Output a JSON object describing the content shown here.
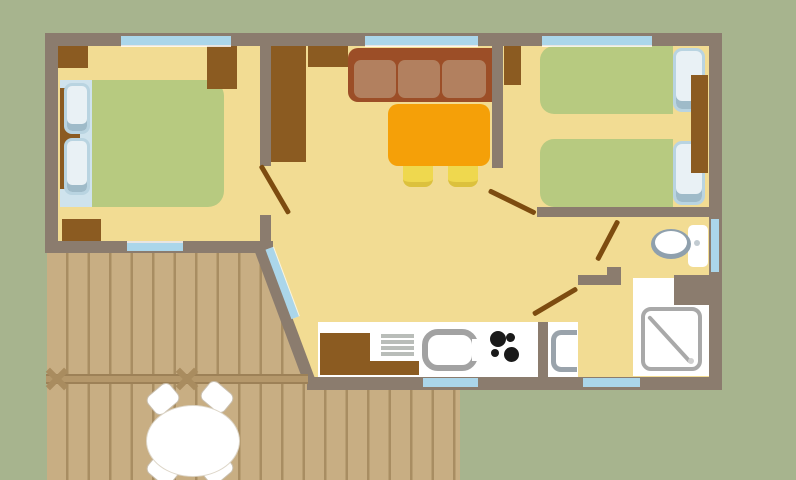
{
  "scene": "mobile-home-floor-plan",
  "canvas": {
    "width": 796,
    "height": 480,
    "background": "#a7b48e"
  },
  "palette": {
    "background_green": "#a7b48e",
    "wall_gray": "#8b7c6e",
    "floor_yellow": "#f2dc93",
    "furniture_brown": "#8b5b21",
    "sofa_dark": "#9c4e27",
    "sofa_light": "#b2805f",
    "table_orange": "#f5a008",
    "stool_yellow": "#efd84e",
    "mattress_green": "#b7ca80",
    "window_blue": "#abd6ea",
    "pillow_blue": "#cfe3ed",
    "deck_plank": "#c8ae83",
    "deck_line": "#a88d62",
    "door_line_brown": "#7d4c10",
    "fixture_white": "#ffffff",
    "fixture_gray": "#a2a2a2"
  },
  "elements": [
    {
      "n": "interior-floor",
      "x": 58,
      "y": 46,
      "w": 651,
      "h": 331,
      "bg": "#f2dc93"
    },
    {
      "n": "deck-planks",
      "x": 47,
      "y": 252,
      "w": 413,
      "h": 228,
      "bg": "repeating-linear-gradient(90deg,#c8ae83 0px,#c8ae83 19px,#a88d62 19px,#a88d62 21.5px)",
      "clip": "polygon(0px 0px, 218px 0px, 266px 125px, 266px 138px, 413px 138px, 413px 228px, 0px 228px)"
    },
    {
      "n": "kitchen-counter",
      "x": 318,
      "y": 322,
      "w": 220,
      "h": 55,
      "bg": "#ffffff"
    },
    {
      "n": "washbasin-area-floor",
      "x": 548,
      "y": 322,
      "w": 30,
      "h": 55,
      "bg": "#ffffff"
    },
    {
      "n": "shower-room-floor",
      "x": 633,
      "y": 278,
      "w": 76,
      "h": 98,
      "bg": "#ffffff"
    },
    {
      "n": "bed1-headboard-base",
      "x": 60,
      "y": 80,
      "w": 33,
      "h": 127,
      "bg": "#cfe3ed"
    },
    {
      "n": "bed1-headboard-wood",
      "x": 60,
      "y": 88,
      "w": 20,
      "h": 101,
      "bg": "#8b5b21"
    },
    {
      "n": "bed1-pillow-top",
      "x": 64,
      "y": 83,
      "w": 26,
      "h": 51,
      "bg": "#e9f1f5",
      "border": "3px solid #b9d4e1",
      "r": "8px",
      "shadow": "inset 0 -7px 0 #9fbbc9"
    },
    {
      "n": "bed1-pillow-bottom",
      "x": 64,
      "y": 138,
      "w": 26,
      "h": 57,
      "bg": "#e9f1f5",
      "border": "3px solid #b9d4e1",
      "r": "8px",
      "shadow": "inset 0 -7px 0 #9fbbc9"
    },
    {
      "n": "bed1-mattress",
      "x": 92,
      "y": 80,
      "w": 132,
      "h": 127,
      "bg": "#b7ca80",
      "r": "0 16px 16px 0"
    },
    {
      "n": "bedroom1-corner-cabinet",
      "x": 58,
      "y": 46,
      "w": 30,
      "h": 22,
      "bg": "#8b5b21"
    },
    {
      "n": "bedroom1-wardrobe",
      "x": 207,
      "y": 46,
      "w": 30,
      "h": 43,
      "bg": "#8b5b21"
    },
    {
      "n": "bedroom1-low-cabinet",
      "x": 62,
      "y": 219,
      "w": 39,
      "h": 22,
      "bg": "#8b5b21"
    },
    {
      "n": "living-closet",
      "x": 271,
      "y": 46,
      "w": 35,
      "h": 116,
      "bg": "#8b5b21"
    },
    {
      "n": "living-shelf",
      "x": 308,
      "y": 46,
      "w": 40,
      "h": 21,
      "bg": "#8b5b21"
    },
    {
      "n": "sofa-frame",
      "x": 348,
      "y": 48,
      "w": 145,
      "h": 54,
      "bg": "#9c4e27",
      "r": "10px 0 0 10px"
    },
    {
      "n": "sofa-cushion-1",
      "x": 354,
      "y": 60,
      "w": 42,
      "h": 38,
      "bg": "#b2805f",
      "r": "7px"
    },
    {
      "n": "sofa-cushion-2",
      "x": 398,
      "y": 60,
      "w": 42,
      "h": 38,
      "bg": "#b2805f",
      "r": "7px"
    },
    {
      "n": "sofa-cushion-3",
      "x": 442,
      "y": 60,
      "w": 44,
      "h": 38,
      "bg": "#b2805f",
      "r": "7px"
    },
    {
      "n": "dining-table",
      "x": 388,
      "y": 104,
      "w": 102,
      "h": 62,
      "bg": "#f5a008",
      "r": "10px"
    },
    {
      "n": "stool-1",
      "x": 403,
      "y": 166,
      "w": 30,
      "h": 21,
      "bg": "#efd84e",
      "r": "0 0 8px 8px",
      "css": {
        "borderBottom": "5px solid #dcc13d"
      }
    },
    {
      "n": "stool-2",
      "x": 448,
      "y": 166,
      "w": 30,
      "h": 21,
      "bg": "#efd84e",
      "r": "0 0 8px 8px",
      "css": {
        "borderBottom": "5px solid #dcc13d"
      }
    },
    {
      "n": "bedroom2-closet",
      "x": 504,
      "y": 46,
      "w": 17,
      "h": 39,
      "bg": "#8b5b21"
    },
    {
      "n": "bed2a-mattress",
      "x": 540,
      "y": 46,
      "w": 133,
      "h": 68,
      "bg": "#b7ca80",
      "r": "14px 0 0 14px"
    },
    {
      "n": "bed2a-pillow",
      "x": 673,
      "y": 48,
      "w": 32,
      "h": 64,
      "bg": "#e9f1f5",
      "border": "3px solid #b9d4e1",
      "r": "9px",
      "shadow": "inset 0 -8px 0 #9fbbc9"
    },
    {
      "n": "bed2b-mattress",
      "x": 540,
      "y": 139,
      "w": 133,
      "h": 68,
      "bg": "#b7ca80",
      "r": "14px 0 0 14px"
    },
    {
      "n": "bed2b-pillow",
      "x": 673,
      "y": 141,
      "w": 32,
      "h": 64,
      "bg": "#e9f1f5",
      "border": "3px solid #b9d4e1",
      "r": "9px",
      "shadow": "inset 0 -8px 0 #9fbbc9"
    },
    {
      "n": "bedroom2-nightstand",
      "x": 691,
      "y": 75,
      "w": 17,
      "h": 98,
      "bg": "#8b5b21"
    },
    {
      "n": "toilet-cistern",
      "x": 688,
      "y": 225,
      "w": 20,
      "h": 42,
      "bg": "#ffffff",
      "r": "5px"
    },
    {
      "n": "toilet-bowl-rim",
      "x": 651,
      "y": 229,
      "w": 40,
      "h": 30,
      "bg": "#8fa0ad",
      "shape": "ellipse"
    },
    {
      "n": "toilet-bowl",
      "x": 655,
      "y": 231,
      "w": 32,
      "h": 23,
      "bg": "#ffffff",
      "shape": "ellipse"
    },
    {
      "n": "toilet-flush-button",
      "x": 694,
      "y": 240,
      "w": 6,
      "h": 6,
      "bg": "#c2cbd1",
      "shape": "ellipse"
    },
    {
      "n": "shower-tray",
      "x": 641,
      "y": 307,
      "w": 61,
      "h": 64,
      "bg": "#ffffff",
      "border": "4px solid #a9a9a9",
      "r": "10px"
    },
    {
      "n": "shower-diagonal-line",
      "x": 650,
      "y": 315,
      "w": 62,
      "h": 4,
      "bg": "#a9a9a9",
      "rot": 47.6,
      "org": "0 0",
      "r": "2px"
    },
    {
      "n": "shower-drain",
      "x": 688,
      "y": 358,
      "w": 6,
      "h": 6,
      "bg": "#cfcfcf",
      "shape": "ellipse"
    },
    {
      "n": "washbasin",
      "x": 551,
      "y": 330,
      "w": 26,
      "h": 42,
      "bg": "#ffffff",
      "border": "5px solid #9aa3ab",
      "r": "10px 0 0 10px",
      "css": {
        "borderRight": "none"
      }
    },
    {
      "n": "kitchen-cabinet-upper",
      "x": 320,
      "y": 333,
      "w": 50,
      "h": 42,
      "bg": "#8b5b21"
    },
    {
      "n": "kitchen-cabinet-lower",
      "x": 370,
      "y": 361,
      "w": 49,
      "h": 14,
      "bg": "#8b5b21"
    },
    {
      "n": "drainer-stripe-1",
      "x": 381,
      "y": 334,
      "w": 33,
      "h": 4,
      "bg": "#b9bdb9"
    },
    {
      "n": "drainer-stripe-2",
      "x": 381,
      "y": 340,
      "w": 33,
      "h": 4,
      "bg": "#b9bdb9"
    },
    {
      "n": "drainer-stripe-3",
      "x": 381,
      "y": 346,
      "w": 33,
      "h": 4,
      "bg": "#b9bdb9"
    },
    {
      "n": "drainer-stripe-4",
      "x": 381,
      "y": 352,
      "w": 33,
      "h": 4,
      "bg": "#b9bdb9"
    },
    {
      "n": "kitchen-sink",
      "x": 422,
      "y": 329,
      "w": 56,
      "h": 42,
      "bg": "#ffffff",
      "border": "6px solid #a2a2a2",
      "r": "16px"
    },
    {
      "n": "kitchen-sink-opening",
      "x": 472,
      "y": 339,
      "w": 8,
      "h": 22,
      "bg": "#ffffff"
    },
    {
      "n": "hob-burner-large-1",
      "x": 490,
      "y": 331,
      "w": 16,
      "h": 16,
      "bg": "#1a1a1a",
      "shape": "ellipse"
    },
    {
      "n": "hob-burner-small-1",
      "x": 506,
      "y": 333,
      "w": 9,
      "h": 9,
      "bg": "#1a1a1a",
      "shape": "ellipse"
    },
    {
      "n": "hob-burner-small-2",
      "x": 491,
      "y": 349,
      "w": 8,
      "h": 8,
      "bg": "#1a1a1a",
      "shape": "ellipse"
    },
    {
      "n": "hob-burner-large-2",
      "x": 504,
      "y": 347,
      "w": 15,
      "h": 15,
      "bg": "#1a1a1a",
      "shape": "ellipse"
    },
    {
      "n": "wall-top",
      "x": 45,
      "y": 33,
      "w": 677,
      "h": 13,
      "bg": "#8b7c6e"
    },
    {
      "n": "wall-left",
      "x": 45,
      "y": 33,
      "w": 13,
      "h": 220,
      "bg": "#8b7c6e"
    },
    {
      "n": "wall-bedroom1-bottom",
      "x": 45,
      "y": 241,
      "w": 228,
      "h": 12,
      "bg": "#8b7c6e"
    },
    {
      "n": "wall-right",
      "x": 709,
      "y": 33,
      "w": 13,
      "h": 357,
      "bg": "#8b7c6e"
    },
    {
      "n": "wall-bottom",
      "x": 307,
      "y": 377,
      "w": 415,
      "h": 13,
      "bg": "#8b7c6e"
    },
    {
      "n": "wall-diagonal",
      "x": 264,
      "y": 242,
      "w": 146,
      "h": 12,
      "bg": "#8b7c6e",
      "rot": 69.5,
      "org": "0 0"
    },
    {
      "n": "wall-bedroom1-partition-upper",
      "x": 260,
      "y": 46,
      "w": 11,
      "h": 120,
      "bg": "#8b7c6e"
    },
    {
      "n": "wall-bedroom1-partition-lower",
      "x": 260,
      "y": 215,
      "w": 11,
      "h": 30,
      "bg": "#8b7c6e"
    },
    {
      "n": "wall-bedroom2-partition",
      "x": 492,
      "y": 46,
      "w": 11,
      "h": 122,
      "bg": "#8b7c6e"
    },
    {
      "n": "wall-bedroom2-bottom",
      "x": 537,
      "y": 207,
      "w": 172,
      "h": 10,
      "bg": "#8b7c6e"
    },
    {
      "n": "wall-bathroom",
      "x": 578,
      "y": 275,
      "w": 43,
      "h": 10,
      "bg": "#8b7c6e"
    },
    {
      "n": "wall-bathroom-jamb",
      "x": 607,
      "y": 267,
      "w": 14,
      "h": 10,
      "bg": "#8b7c6e"
    },
    {
      "n": "wall-bathroom-block",
      "x": 674,
      "y": 275,
      "w": 35,
      "h": 30,
      "bg": "#8b7c6e"
    },
    {
      "n": "wall-kitchen-partition",
      "x": 538,
      "y": 322,
      "w": 10,
      "h": 55,
      "bg": "#8b7c6e"
    },
    {
      "n": "window-bedroom1-top",
      "x": 121,
      "y": 36,
      "w": 110,
      "h": 9,
      "bg": "#abd6ea",
      "shadow": "0 2px 0 rgba(255,255,255,0.8)"
    },
    {
      "n": "window-living-top",
      "x": 365,
      "y": 36,
      "w": 113,
      "h": 9,
      "bg": "#abd6ea",
      "shadow": "0 2px 0 rgba(255,255,255,0.8)"
    },
    {
      "n": "window-bedroom2-top",
      "x": 542,
      "y": 36,
      "w": 110,
      "h": 9,
      "bg": "#abd6ea",
      "shadow": "0 2px 0 rgba(255,255,255,0.8)"
    },
    {
      "n": "window-bedroom1-bottom",
      "x": 127,
      "y": 243,
      "w": 56,
      "h": 8,
      "bg": "#abd6ea",
      "shadow": "0 -2px 0 rgba(255,255,255,0.8)"
    },
    {
      "n": "window-bathroom-right",
      "x": 711,
      "y": 219,
      "w": 8,
      "h": 53,
      "bg": "#abd6ea"
    },
    {
      "n": "window-kitchen-bottom",
      "x": 423,
      "y": 378,
      "w": 55,
      "h": 9,
      "bg": "#abd6ea"
    },
    {
      "n": "window-bathroom-bottom",
      "x": 583,
      "y": 378,
      "w": 57,
      "h": 9,
      "bg": "#abd6ea"
    },
    {
      "n": "window-entrance-diagonal",
      "x": 273,
      "y": 247,
      "w": 74,
      "h": 8,
      "bg": "#abd6ea",
      "rot": 69.5,
      "org": "0 0",
      "shadow": "0 -1px 0 rgba(255,255,255,0.7)"
    },
    {
      "n": "door-swing-bedroom1",
      "x": 261,
      "y": 163,
      "w": 56,
      "h": 4.5,
      "bg": "#7d4c10",
      "rot": 59.7,
      "org": "0 50%",
      "r": "2px"
    },
    {
      "n": "door-swing-bedroom2",
      "x": 489,
      "y": 188,
      "w": 52,
      "h": 4.5,
      "bg": "#7d4c10",
      "rot": 26.1,
      "org": "0 50%",
      "r": "2px"
    },
    {
      "n": "door-swing-toilet",
      "x": 597,
      "y": 258,
      "w": 45,
      "h": 4.5,
      "bg": "#7d4c10",
      "rot": -62.3,
      "org": "0 50%",
      "r": "2px"
    },
    {
      "n": "door-swing-bathroom",
      "x": 533,
      "y": 312,
      "w": 51,
      "h": 4.5,
      "bg": "#7d4c10",
      "rot": -30.6,
      "org": "0 50%",
      "r": "2px"
    },
    {
      "n": "deck-railing",
      "x": 46,
      "y": 374,
      "w": 262,
      "h": 10,
      "bg": "#b5986b",
      "shadow": "inset 0 2px 0 #9d8157, inset 0 -2px 0 #9d8157"
    },
    {
      "n": "railing-tie-1a",
      "x": 44,
      "y": 376,
      "w": 26,
      "h": 6,
      "bg": "#a98c5f",
      "rot": 45
    },
    {
      "n": "railing-tie-1b",
      "x": 44,
      "y": 376,
      "w": 26,
      "h": 6,
      "bg": "#a98c5f",
      "rot": -45
    },
    {
      "n": "railing-tie-2a",
      "x": 174,
      "y": 376,
      "w": 26,
      "h": 6,
      "bg": "#a98c5f",
      "rot": 45
    },
    {
      "n": "railing-tie-2b",
      "x": 174,
      "y": 376,
      "w": 26,
      "h": 6,
      "bg": "#a98c5f",
      "rot": -45
    },
    {
      "n": "deck-chair-top-left",
      "x": 148,
      "y": 387,
      "w": 30,
      "h": 24,
      "bg": "#ffffff",
      "border": "1.5px solid #c9bfae",
      "r": "7px",
      "rot": -40
    },
    {
      "n": "deck-chair-top-right",
      "x": 202,
      "y": 385,
      "w": 30,
      "h": 24,
      "bg": "#ffffff",
      "border": "1.5px solid #c9bfae",
      "r": "7px",
      "rot": 40
    },
    {
      "n": "deck-chair-bottom-left",
      "x": 148,
      "y": 458,
      "w": 30,
      "h": 24,
      "bg": "#ffffff",
      "border": "1.5px solid #c9bfae",
      "r": "7px",
      "rot": 40
    },
    {
      "n": "deck-chair-bottom-right",
      "x": 202,
      "y": 457,
      "w": 30,
      "h": 24,
      "bg": "#ffffff",
      "border": "1.5px solid #c9bfae",
      "r": "7px",
      "rot": -40
    },
    {
      "n": "deck-table",
      "x": 146,
      "y": 405,
      "w": 94,
      "h": 72,
      "bg": "#ffffff",
      "border": "1.5px solid #ddd6c8",
      "shape": "ellipse"
    }
  ]
}
